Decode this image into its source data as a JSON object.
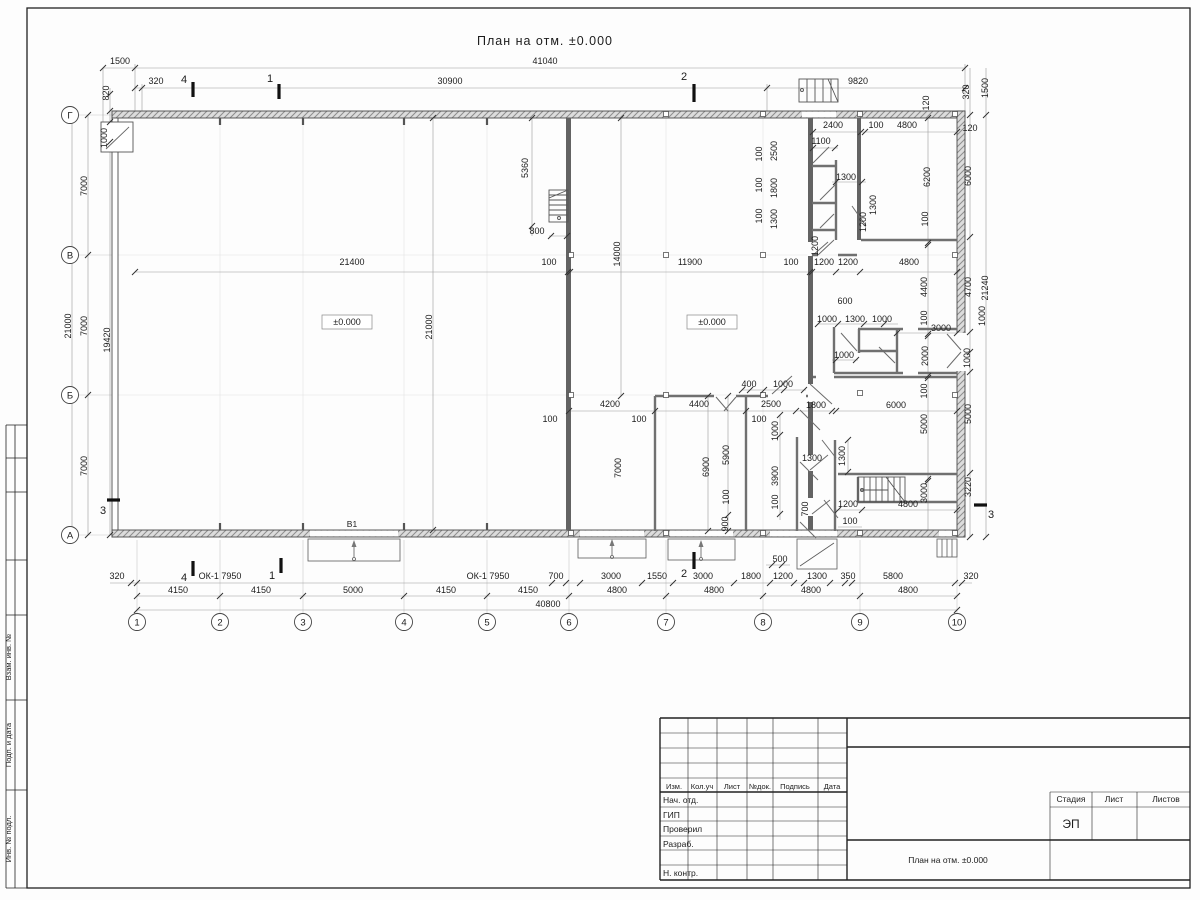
{
  "sheet": {
    "title": "План на отм. ±0.000"
  },
  "plan": {
    "elevation_labels": [
      "±0.000",
      "±0.000"
    ],
    "gate_label": "В1",
    "window_labels": [
      "ОК-1 7950",
      "ОК-1 7950"
    ],
    "dims": [
      [
        "41040",
        545,
        64
      ],
      [
        "1500",
        120,
        64
      ],
      [
        "320",
        156,
        84
      ],
      [
        "30900",
        450,
        84
      ],
      [
        "9820",
        858,
        84
      ],
      [
        "820",
        109,
        93,
        1
      ],
      [
        "1000",
        107,
        138,
        1
      ],
      [
        "320",
        969,
        92,
        1
      ],
      [
        "1500",
        988,
        88,
        1
      ],
      [
        "120",
        929,
        103,
        1
      ],
      [
        "7000",
        87,
        186,
        1
      ],
      [
        "7000",
        87,
        326,
        1
      ],
      [
        "7000",
        87,
        466,
        1
      ],
      [
        "21000",
        71,
        326,
        1
      ],
      [
        "19420",
        110,
        340,
        1
      ],
      [
        "120",
        970,
        131
      ],
      [
        "6000",
        971,
        176,
        1
      ],
      [
        "4700",
        971,
        287,
        1
      ],
      [
        "21240",
        988,
        288,
        1
      ],
      [
        "1000",
        985,
        316,
        1
      ],
      [
        "1000",
        970,
        358,
        1
      ],
      [
        "5000",
        971,
        414,
        1
      ],
      [
        "3220",
        971,
        487,
        1
      ],
      [
        "21400",
        352,
        265
      ],
      [
        "100",
        549,
        265
      ],
      [
        "11900",
        690,
        265
      ],
      [
        "100",
        791,
        265
      ],
      [
        "1200",
        824,
        265
      ],
      [
        "1200",
        848,
        265
      ],
      [
        "4800",
        909,
        265
      ],
      [
        "5360",
        528,
        168,
        1
      ],
      [
        "800",
        537,
        234
      ],
      [
        "14000",
        620,
        254,
        1
      ],
      [
        "21000",
        432,
        327,
        1
      ],
      [
        "2400",
        833,
        128
      ],
      [
        "100",
        876,
        128
      ],
      [
        "4800",
        907,
        128
      ],
      [
        "1100",
        821,
        144
      ],
      [
        "2500",
        777,
        151,
        1
      ],
      [
        "100",
        762,
        154,
        1
      ],
      [
        "1800",
        777,
        188,
        1
      ],
      [
        "100",
        762,
        185,
        1
      ],
      [
        "1300",
        777,
        219,
        1
      ],
      [
        "100",
        762,
        216,
        1
      ],
      [
        "1300",
        846,
        180
      ],
      [
        "1300",
        876,
        205,
        1
      ],
      [
        "1200",
        866,
        222,
        1
      ],
      [
        "6200",
        930,
        177,
        1
      ],
      [
        "100",
        928,
        219,
        1
      ],
      [
        "1200",
        818,
        246,
        1
      ],
      [
        "4400",
        927,
        287,
        1
      ],
      [
        "100",
        927,
        318,
        1
      ],
      [
        "600",
        845,
        304
      ],
      [
        "1000",
        827,
        322
      ],
      [
        "1300",
        855,
        322
      ],
      [
        "1000",
        882,
        322
      ],
      [
        "3000",
        941,
        331
      ],
      [
        "1000",
        844,
        358
      ],
      [
        "2000",
        928,
        356,
        1
      ],
      [
        "100",
        927,
        391,
        1
      ],
      [
        "1800",
        816,
        408
      ],
      [
        "6000",
        896,
        408
      ],
      [
        "1300",
        812,
        461
      ],
      [
        "1300",
        845,
        456,
        1
      ],
      [
        "700",
        808,
        509,
        1
      ],
      [
        "1200",
        848,
        507
      ],
      [
        "100",
        850,
        524
      ],
      [
        "4800",
        908,
        507
      ],
      [
        "5000",
        927,
        424,
        1
      ],
      [
        "3000",
        927,
        493,
        1
      ],
      [
        "4200",
        610,
        407
      ],
      [
        "4400",
        699,
        407
      ],
      [
        "2500",
        771,
        407
      ],
      [
        "100",
        639,
        422
      ],
      [
        "100",
        550,
        422
      ],
      [
        "100",
        759,
        422
      ],
      [
        "400",
        749,
        387
      ],
      [
        "1000",
        783,
        387
      ],
      [
        "7000",
        621,
        468,
        1
      ],
      [
        "6900",
        709,
        467,
        1
      ],
      [
        "5900",
        729,
        455,
        1
      ],
      [
        "100",
        729,
        497,
        1
      ],
      [
        "900",
        728,
        524,
        1
      ],
      [
        "1000",
        778,
        431,
        1
      ],
      [
        "3900",
        778,
        476,
        1
      ],
      [
        "100",
        778,
        502,
        1
      ],
      [
        "320",
        117,
        579
      ],
      [
        "700",
        556,
        579
      ],
      [
        "3000",
        611,
        579
      ],
      [
        "1550",
        657,
        579
      ],
      [
        "3000",
        703,
        579
      ],
      [
        "1800",
        751,
        579
      ],
      [
        "1200",
        783,
        579
      ],
      [
        "500",
        780,
        562
      ],
      [
        "1300",
        817,
        579
      ],
      [
        "350",
        848,
        579
      ],
      [
        "5800",
        893,
        579
      ],
      [
        "320",
        971,
        579
      ],
      [
        "4150",
        178,
        593
      ],
      [
        "4150",
        261,
        593
      ],
      [
        "5000",
        353,
        593
      ],
      [
        "4150",
        446,
        593
      ],
      [
        "4150",
        528,
        593
      ],
      [
        "4800",
        617,
        593
      ],
      [
        "4800",
        714,
        593
      ],
      [
        "4800",
        811,
        593
      ],
      [
        "4800",
        908,
        593
      ],
      [
        "40800",
        548,
        607
      ]
    ]
  },
  "axes": {
    "columns": [
      "1",
      "2",
      "3",
      "4",
      "5",
      "6",
      "7",
      "8",
      "9",
      "10"
    ],
    "rows": [
      "Г",
      "В",
      "Б",
      "А"
    ]
  },
  "section_marks": {
    "labels": [
      "4",
      "1",
      "2",
      "4",
      "1",
      "2",
      "3",
      "3"
    ]
  },
  "side_stamp": {
    "labels": [
      "Взам. инв. №",
      "Подп. и дата",
      "Инв. № подл."
    ]
  },
  "title_block": {
    "header_cols": [
      "Изм.",
      "Кол.уч",
      "Лист",
      "№док.",
      "Подпись",
      "Дата"
    ],
    "rows": [
      "Нач. отд.",
      "ГИП",
      "Проверил",
      "Разраб.",
      "",
      "Н. контр."
    ],
    "stage_cols": [
      "Стадия",
      "Лист",
      "Листов"
    ],
    "stage_value": "ЭП",
    "doc_title": "План на отм. ±0.000"
  }
}
